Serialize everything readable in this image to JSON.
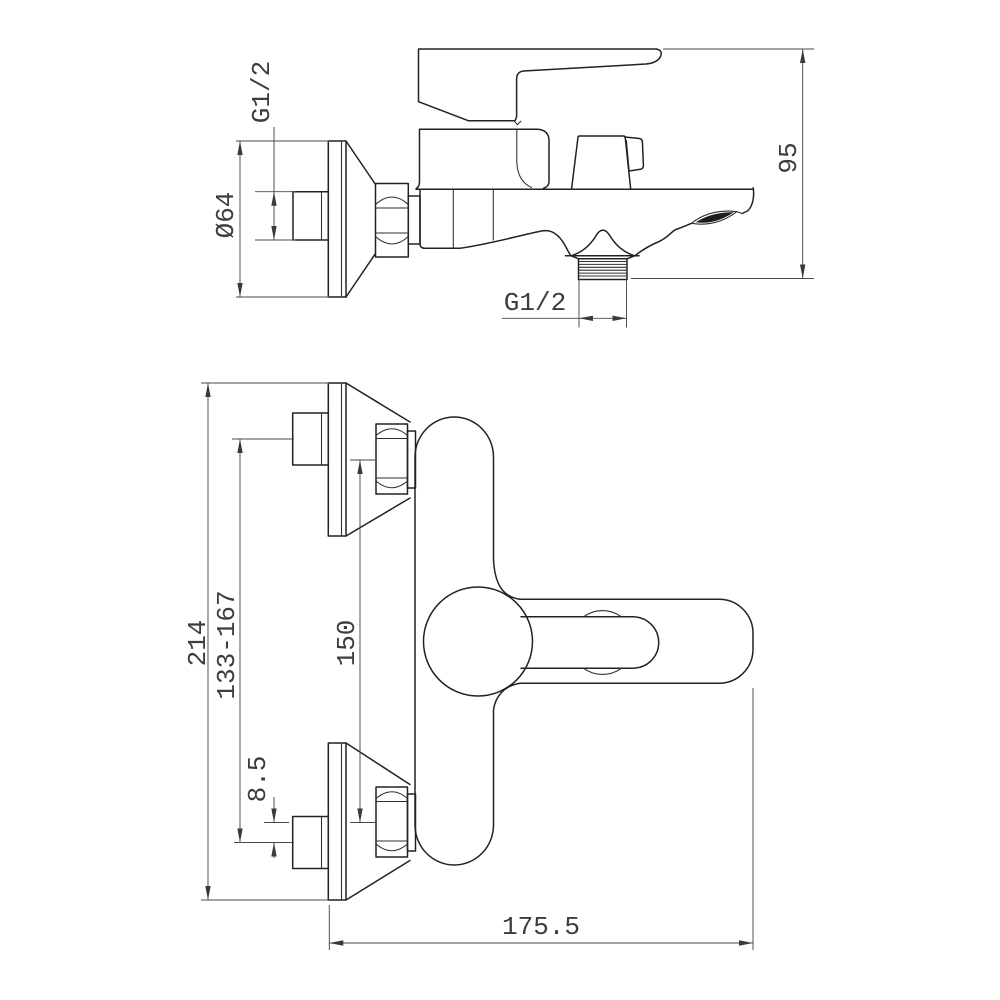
{
  "drawing_type": "faucet installation technical drawing, two orthographic views",
  "colors": {
    "background": "#ffffff",
    "part_line": "#222222",
    "dimension_line": "#4a4a4a",
    "text": "#3d3d3d"
  },
  "side_view": {
    "dimensions": [
      {
        "label": "G1/2"
      },
      {
        "label": "Ø64"
      },
      {
        "label": "95"
      },
      {
        "label": "G1/2"
      }
    ]
  },
  "front_view": {
    "dimensions": [
      {
        "label": "214"
      },
      {
        "label": "133-167"
      },
      {
        "label": "150"
      },
      {
        "label": "8.5"
      },
      {
        "label": "175.5"
      }
    ]
  }
}
